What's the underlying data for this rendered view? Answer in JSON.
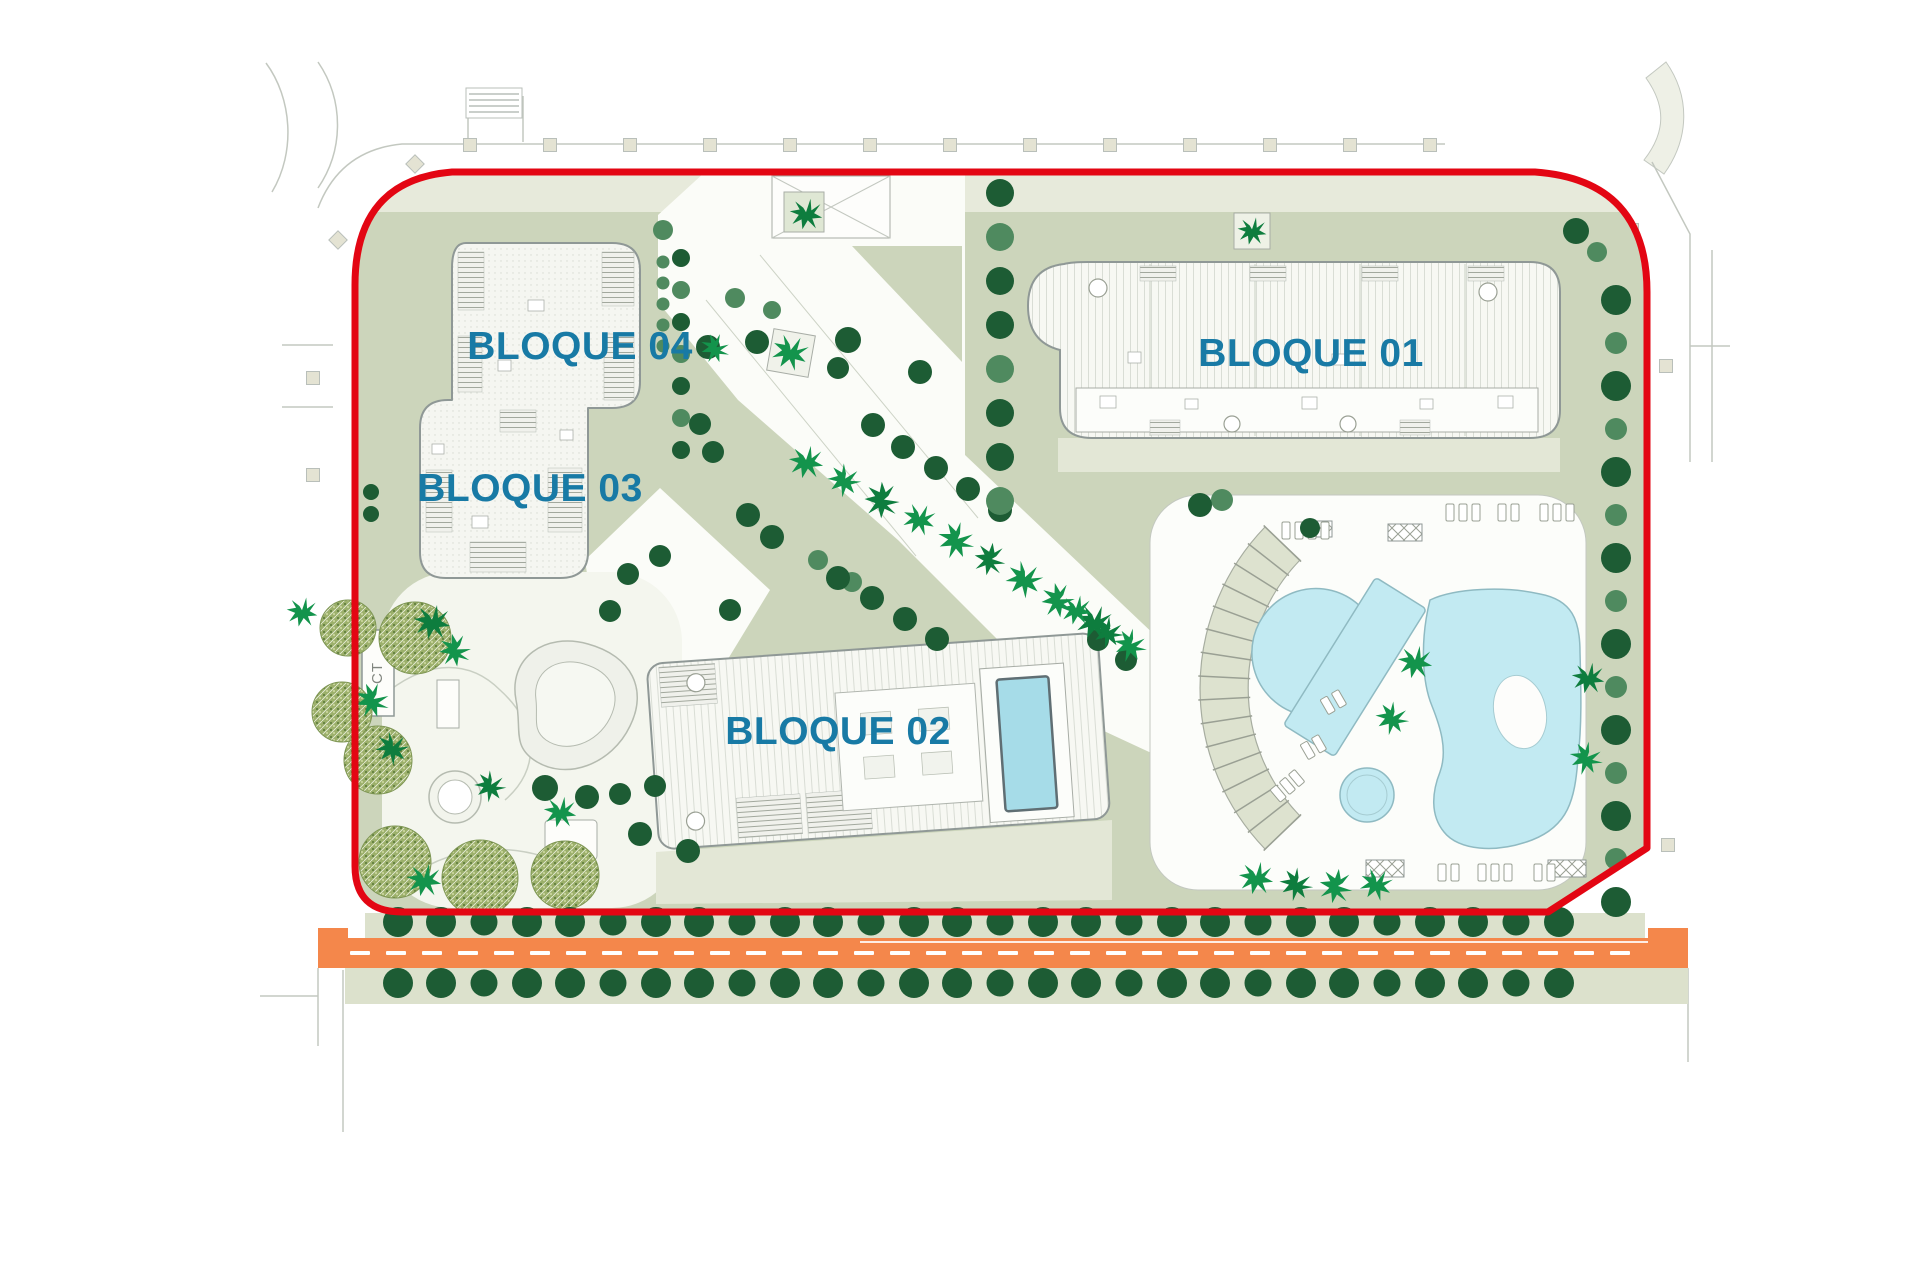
{
  "labels": {
    "bloque01": "BLOQUE 01",
    "bloque02": "BLOQUE 02",
    "bloque03": "BLOQUE 03",
    "bloque04": "BLOQUE 04",
    "ct": "CT"
  },
  "colors": {
    "boundary_red": "#e30613",
    "label_blue": "#187aa5",
    "road_orange": "#f4874b",
    "sage": "#ccd5bb",
    "sage_light": "#e7eadb",
    "road_verge": "#dce1cc",
    "pool_blue": "#c2eaf2",
    "b02_pool_blue": "#a6dce8",
    "tree_dark": "#1d5c34",
    "tree_medium": "#4f8a5f",
    "palm_green": "#13944c",
    "palm_green_dark": "#0e7d3e",
    "olive_green": "#9cb06b",
    "building_outline": "#8f9896"
  },
  "trees": {
    "road_rows": [
      {
        "y": 922,
        "x_start": 398,
        "x_step": 43,
        "count": 28,
        "r": 15
      },
      {
        "y": 983,
        "x_start": 398,
        "x_step": 43,
        "count": 28,
        "r": 15
      }
    ],
    "right_column": {
      "x": 1616,
      "y_start": 300,
      "y_step": 43,
      "count": 15,
      "extras": [
        [
          1597,
          252,
          10,
          "m"
        ],
        [
          1576,
          231,
          13,
          "d"
        ]
      ]
    },
    "top_column": {
      "x": 1000,
      "y_start": 193,
      "y_step": 44,
      "count": 8
    },
    "b04_columns": [
      {
        "x": 663,
        "y_start": 262,
        "y_step": 21,
        "count": 5,
        "r": 6.5,
        "shade": "m"
      },
      {
        "x": 681,
        "y_start": 258,
        "y_step": 32,
        "count": 7,
        "r": 9,
        "shade": "alt"
      }
    ],
    "scatter_dark": [
      [
        708,
        347,
        12
      ],
      [
        757,
        342,
        12
      ],
      [
        848,
        340,
        13
      ],
      [
        838,
        368,
        11
      ],
      [
        920,
        372,
        12
      ],
      [
        700,
        424,
        11
      ],
      [
        713,
        452,
        11
      ],
      [
        748,
        515,
        12
      ],
      [
        772,
        537,
        12
      ],
      [
        873,
        425,
        12
      ],
      [
        903,
        447,
        12
      ],
      [
        936,
        468,
        12
      ],
      [
        968,
        489,
        12
      ],
      [
        1000,
        510,
        12
      ],
      [
        660,
        556,
        11
      ],
      [
        628,
        574,
        11
      ],
      [
        838,
        578,
        12
      ],
      [
        872,
        598,
        12
      ],
      [
        905,
        619,
        12
      ],
      [
        937,
        639,
        12
      ],
      [
        545,
        788,
        13
      ],
      [
        587,
        797,
        12
      ],
      [
        620,
        794,
        11
      ],
      [
        655,
        786,
        11
      ],
      [
        610,
        611,
        11
      ],
      [
        640,
        834,
        12
      ],
      [
        688,
        851,
        12
      ],
      [
        1200,
        505,
        12
      ],
      [
        1098,
        640,
        11
      ],
      [
        1126,
        660,
        11
      ],
      [
        730,
        610,
        11
      ],
      [
        371,
        492,
        8
      ],
      [
        371,
        514,
        8
      ],
      [
        1310,
        528,
        10
      ]
    ],
    "scatter_medium": [
      [
        663,
        230,
        10
      ],
      [
        1222,
        500,
        11
      ],
      [
        818,
        560,
        10
      ],
      [
        852,
        582,
        10
      ],
      [
        735,
        298,
        10
      ],
      [
        772,
        310,
        9
      ]
    ],
    "palms": [
      [
        806,
        214,
        0.9,
        0
      ],
      [
        790,
        352,
        1,
        20
      ],
      [
        715,
        348,
        0.8,
        60
      ],
      [
        1252,
        231,
        0.8,
        0
      ],
      [
        806,
        462,
        0.95,
        0
      ],
      [
        844,
        480,
        0.9,
        40
      ],
      [
        882,
        500,
        1,
        80
      ],
      [
        919,
        519,
        0.9,
        15
      ],
      [
        956,
        540,
        1,
        55
      ],
      [
        990,
        559,
        0.9,
        90
      ],
      [
        1024,
        579,
        1,
        30
      ],
      [
        1058,
        600,
        0.95,
        70
      ],
      [
        1094,
        622,
        1,
        10
      ],
      [
        1130,
        645,
        0.9,
        50
      ],
      [
        1076,
        610,
        0.85,
        0
      ],
      [
        1108,
        632,
        0.85,
        45
      ],
      [
        1415,
        662,
        0.95,
        0
      ],
      [
        1392,
        718,
        0.9,
        45
      ],
      [
        1588,
        678,
        0.9,
        0
      ],
      [
        1586,
        758,
        0.9,
        50
      ],
      [
        1256,
        878,
        0.95,
        0
      ],
      [
        1296,
        884,
        0.9,
        45
      ],
      [
        1336,
        886,
        0.95,
        90
      ],
      [
        1376,
        884,
        0.9,
        20
      ],
      [
        432,
        622,
        1,
        0
      ],
      [
        455,
        650,
        0.9,
        70
      ],
      [
        372,
        700,
        0.95,
        60
      ],
      [
        392,
        748,
        0.9,
        30
      ],
      [
        424,
        880,
        0.95,
        0
      ],
      [
        560,
        812,
        0.9,
        0
      ],
      [
        490,
        786,
        0.85,
        40
      ],
      [
        302,
        612,
        0.85,
        0
      ]
    ],
    "olives": [
      [
        415,
        638,
        36
      ],
      [
        378,
        760,
        34
      ],
      [
        395,
        862,
        36
      ],
      [
        480,
        878,
        38
      ],
      [
        565,
        875,
        34
      ],
      [
        348,
        628,
        28
      ],
      [
        342,
        712,
        30
      ]
    ]
  },
  "street_squares": [
    [
      470,
      145,
      0
    ],
    [
      550,
      145,
      0
    ],
    [
      630,
      145,
      0
    ],
    [
      710,
      145,
      0
    ],
    [
      790,
      145,
      0
    ],
    [
      870,
      145,
      0
    ],
    [
      950,
      145,
      0
    ],
    [
      1030,
      145,
      0
    ],
    [
      1110,
      145,
      0
    ],
    [
      1190,
      145,
      0
    ],
    [
      1270,
      145,
      0
    ],
    [
      1350,
      145,
      0
    ],
    [
      1430,
      145,
      0
    ],
    [
      313,
      378,
      0
    ],
    [
      313,
      475,
      0
    ],
    [
      338,
      240,
      45
    ],
    [
      415,
      164,
      45
    ],
    [
      1632,
      230,
      0
    ],
    [
      1666,
      366,
      0
    ],
    [
      1668,
      845,
      0
    ]
  ],
  "loungers": [
    {
      "x": 1282,
      "y": 522,
      "n": 4,
      "dx": 13,
      "w": 8,
      "h": 17,
      "rot": 0
    },
    {
      "x": 1446,
      "y": 504,
      "n": 3,
      "dx": 13,
      "w": 8,
      "h": 17,
      "rot": 0
    },
    {
      "x": 1498,
      "y": 504,
      "n": 2,
      "dx": 13,
      "w": 8,
      "h": 17,
      "rot": 0
    },
    {
      "x": 1540,
      "y": 504,
      "n": 3,
      "dx": 13,
      "w": 8,
      "h": 17,
      "rot": 0
    },
    {
      "x": 1438,
      "y": 864,
      "n": 2,
      "dx": 13,
      "w": 8,
      "h": 17,
      "rot": 0
    },
    {
      "x": 1478,
      "y": 864,
      "n": 3,
      "dx": 13,
      "w": 8,
      "h": 17,
      "rot": 0
    },
    {
      "x": 1534,
      "y": 864,
      "n": 2,
      "dx": 13,
      "w": 8,
      "h": 17,
      "rot": 0
    },
    {
      "x": 1320,
      "y": 700,
      "n": 2,
      "dx": 13,
      "w": 8,
      "h": 17,
      "rot": -30
    },
    {
      "x": 1300,
      "y": 745,
      "n": 2,
      "dx": 13,
      "w": 8,
      "h": 17,
      "rot": -30
    },
    {
      "x": 1270,
      "y": 790,
      "n": 3,
      "dx": 12,
      "w": 8,
      "h": 16,
      "rot": -40
    }
  ],
  "pergolas": [
    [
      1306,
      521,
      26,
      16
    ],
    [
      1388,
      524,
      34,
      17
    ],
    [
      1366,
      860,
      38,
      17
    ],
    [
      1548,
      860,
      38,
      17
    ]
  ],
  "road": {
    "dash": {
      "x1": 350,
      "x2": 1640,
      "step": 36,
      "w": 20,
      "h": 4,
      "y": 951
    }
  },
  "amphitheater": {
    "cx": 1432,
    "cy": 688,
    "r_inner": 184,
    "r_outer": 232,
    "a_start": 136,
    "a_end": 224,
    "steps": 15
  }
}
